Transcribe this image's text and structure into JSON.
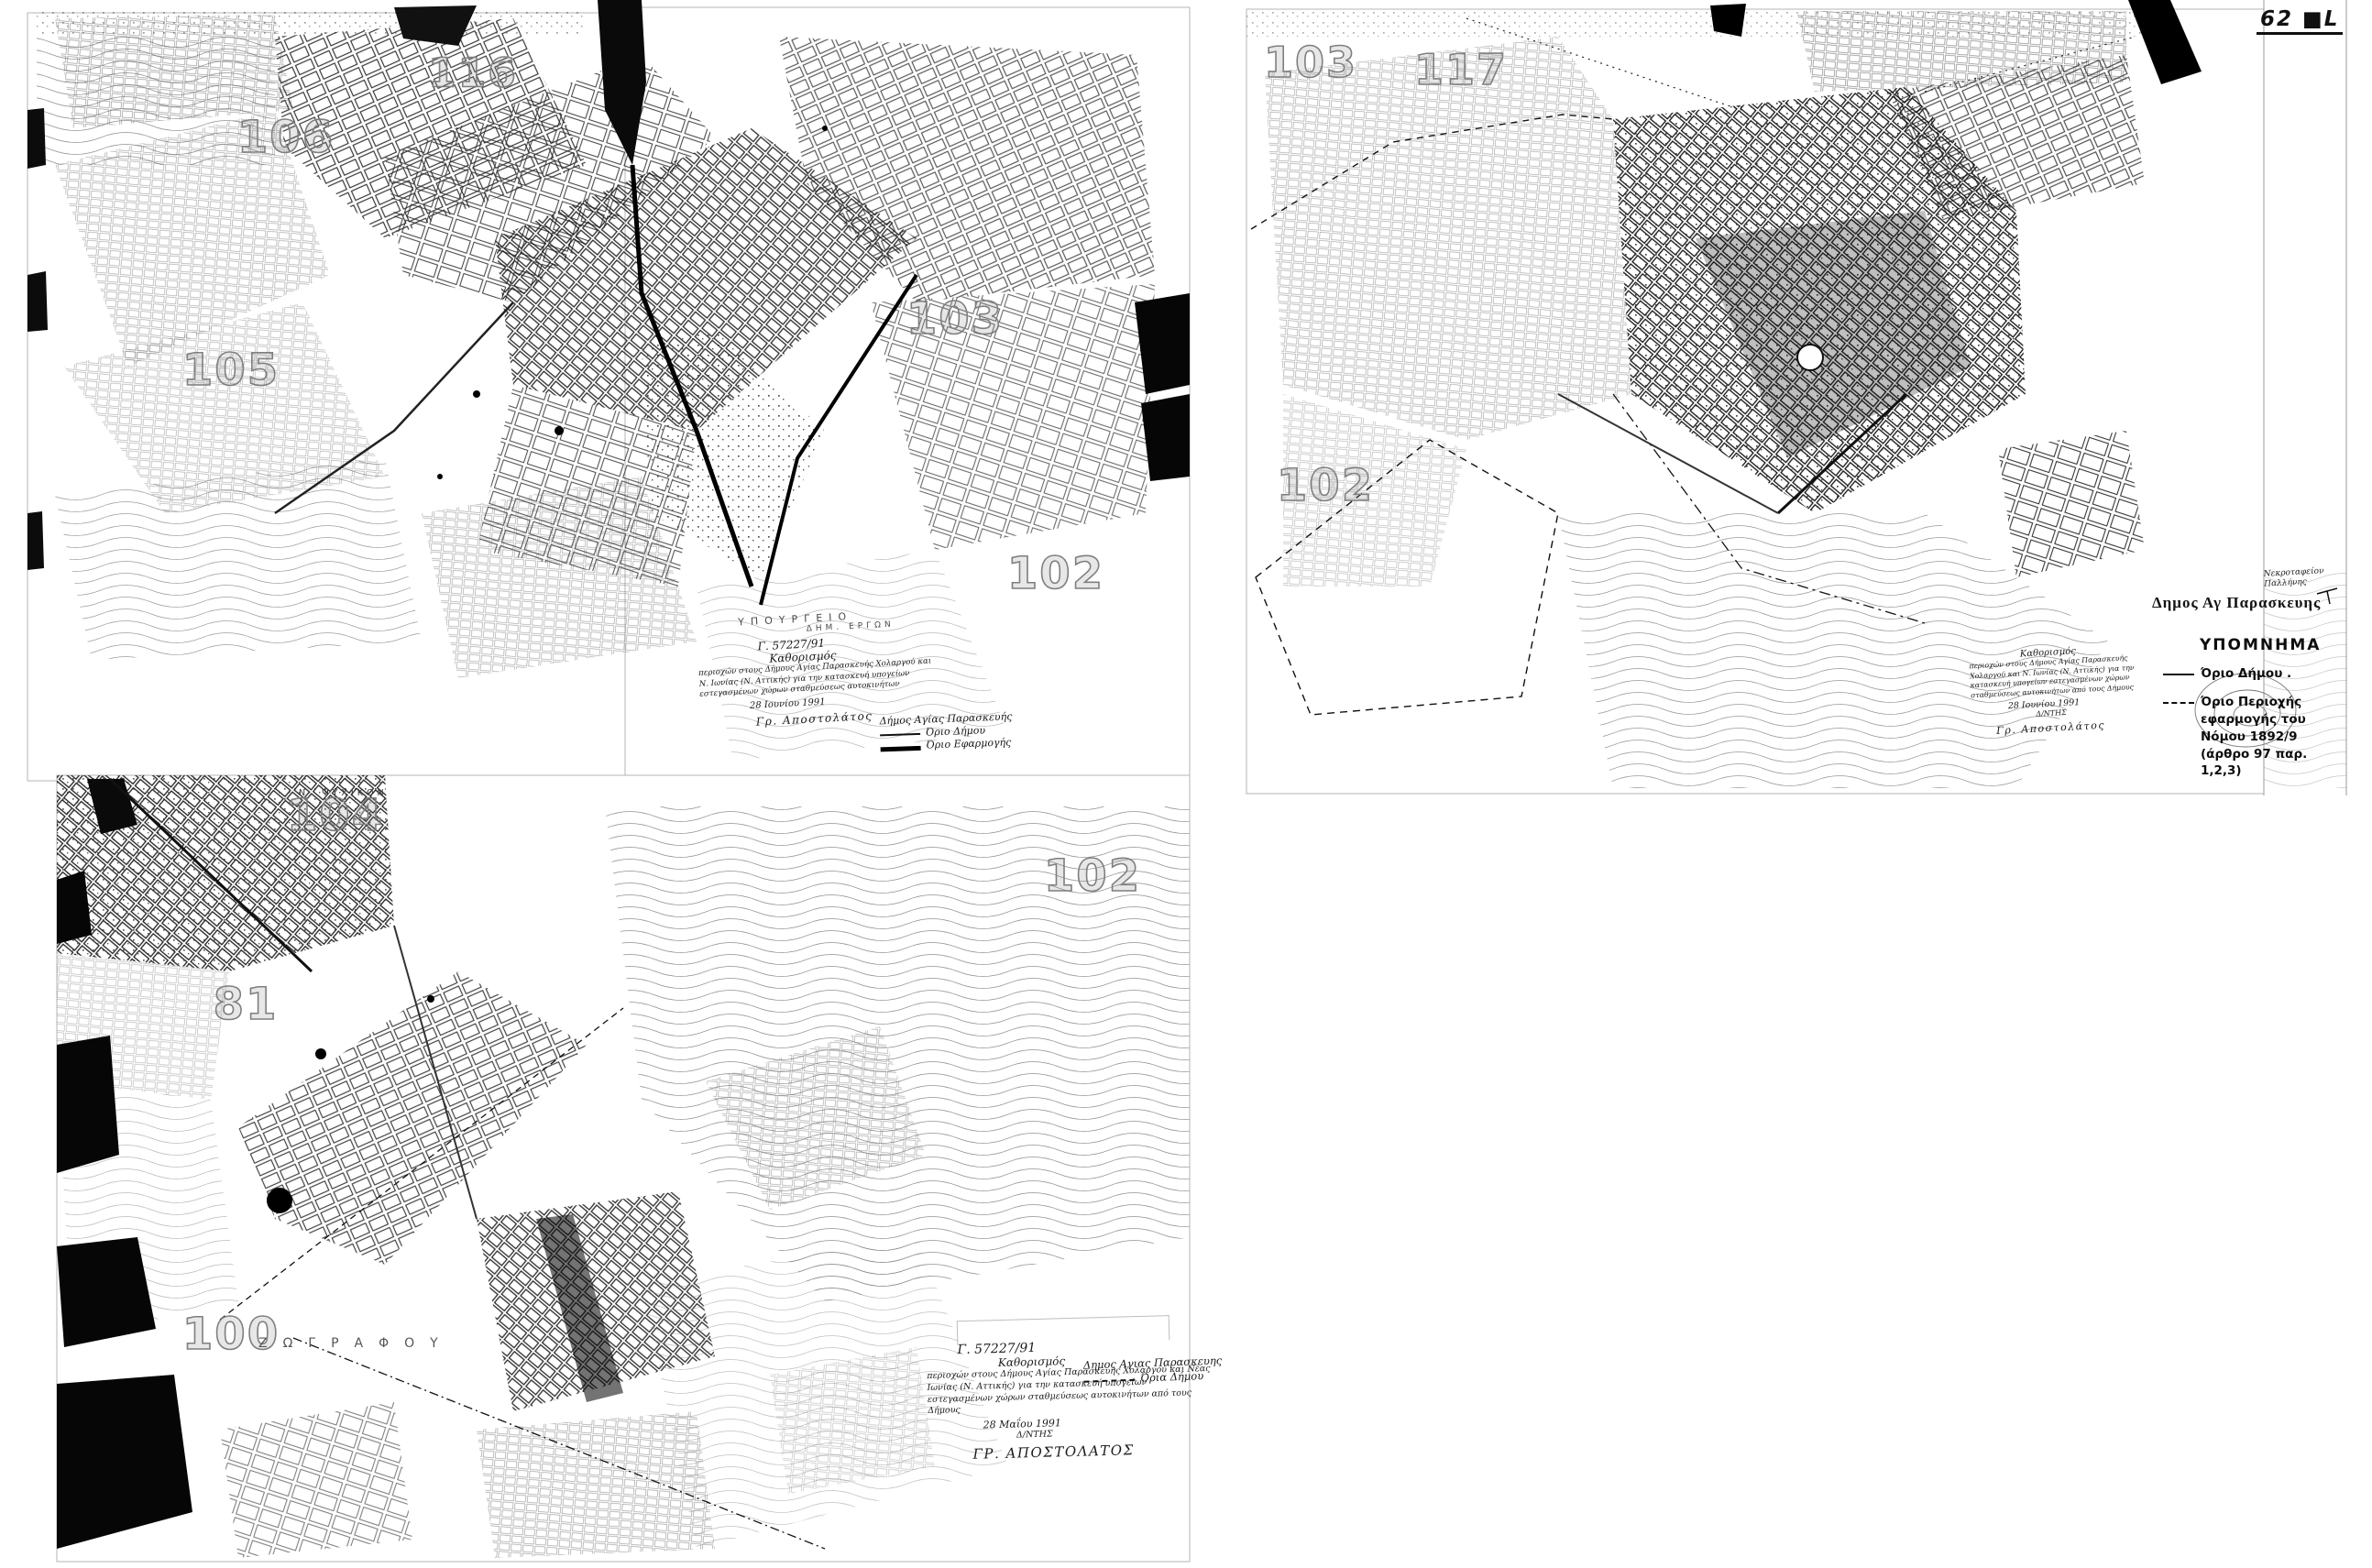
{
  "page": {
    "corner_label": "62 ■L"
  },
  "sheet_numbers": [
    {
      "label": "106"
    },
    {
      "label": "116"
    },
    {
      "label": "105"
    },
    {
      "label": "103"
    },
    {
      "label": "102"
    },
    {
      "label": "103"
    },
    {
      "label": "117"
    },
    {
      "label": "102"
    },
    {
      "label": "104"
    },
    {
      "label": "81"
    },
    {
      "label": "100"
    },
    {
      "label": "102"
    }
  ],
  "area_labels": {
    "municipality": "Δημος Αγ Παρασκευης",
    "cemetery_line1": "Νεκροταφείον",
    "cemetery_line2": "Παλλήνης",
    "n_psychiko": "Ν. ΨΥΧΙΚΟΝ",
    "zografou": "ΖΩΓΡΑΦΟΥ"
  },
  "legend": {
    "title": "ΥΠΟΜΝΗΜΑ",
    "items": [
      {
        "symbol": "solid-line",
        "label": "Όριο Δήμου ."
      },
      {
        "symbol": "dashed-line",
        "label": "Όριο Περιοχής εφαρμογής του Νόμου 1892/9 (άρθρο 97 παρ. 1,2,3)"
      }
    ]
  },
  "inline_legend_left_map": {
    "title": "Δήμος Αγίας Παρασκευής",
    "item1": "Όριο Δήμου",
    "item2": "Όριο Εφαρμογής"
  },
  "mini_legend_bottom_map": {
    "title": "Δημος Αγιας Παρασκευης",
    "item1": "Όρια Δήμου"
  },
  "stamps": {
    "ministry": {
      "dept_line1": "ΥΠΟΥΡΓΕΙΟ",
      "dept_line2": "ΔΗΜ. ΕΡΓΩΝ",
      "ref": "Γ. 57227/91",
      "title": "Καθορισμός",
      "body": "περιοχών στους Δήμους Αγίας Παρασκευής Χολαργού και Ν. Ιωνίας (Ν. Αττικής) για την κατασκευή υπογείων εστεγασμένων χώρων σταθμεύσεως αυτοκινήτων",
      "date": "28 Ιουνίου 1991",
      "signature": "Γρ. Αποστολάτος"
    },
    "right_map": {
      "title": "Καθορισμός",
      "body": "περιοχών στους Δήμους Αγίας Παρασκευής Χολαργού και Ν. Ιωνίας (Ν. Αττικής) για την κατασκευή υπογείων εστεγασμένων χώρων σταθμεύσεως αυτοκινήτων από τους Δήμους",
      "date": "28 Ιουνίου 1991",
      "role": "Δ/ΝΤΗΣ",
      "signature": "Γρ. Αποστολάτος"
    },
    "bottom_map": {
      "ref": "Γ. 57227/91",
      "title": "Καθορισμός",
      "body": "περιοχών στους Δήμους Αγίας Παρασκευής Χολαργού και Νέας Ιωνίας (Ν. Αττικής) για την κατασκευή υπογείων εστεγασμένων χώρων σταθμεύσεως αυτοκινήτων από τους Δήμους",
      "date": "28 Μαΐου 1991",
      "role": "Δ/ΝΤΗΣ",
      "signature": "ΓΡ. ΑΠΟΣΤΟΛΑΤΟΣ"
    }
  }
}
